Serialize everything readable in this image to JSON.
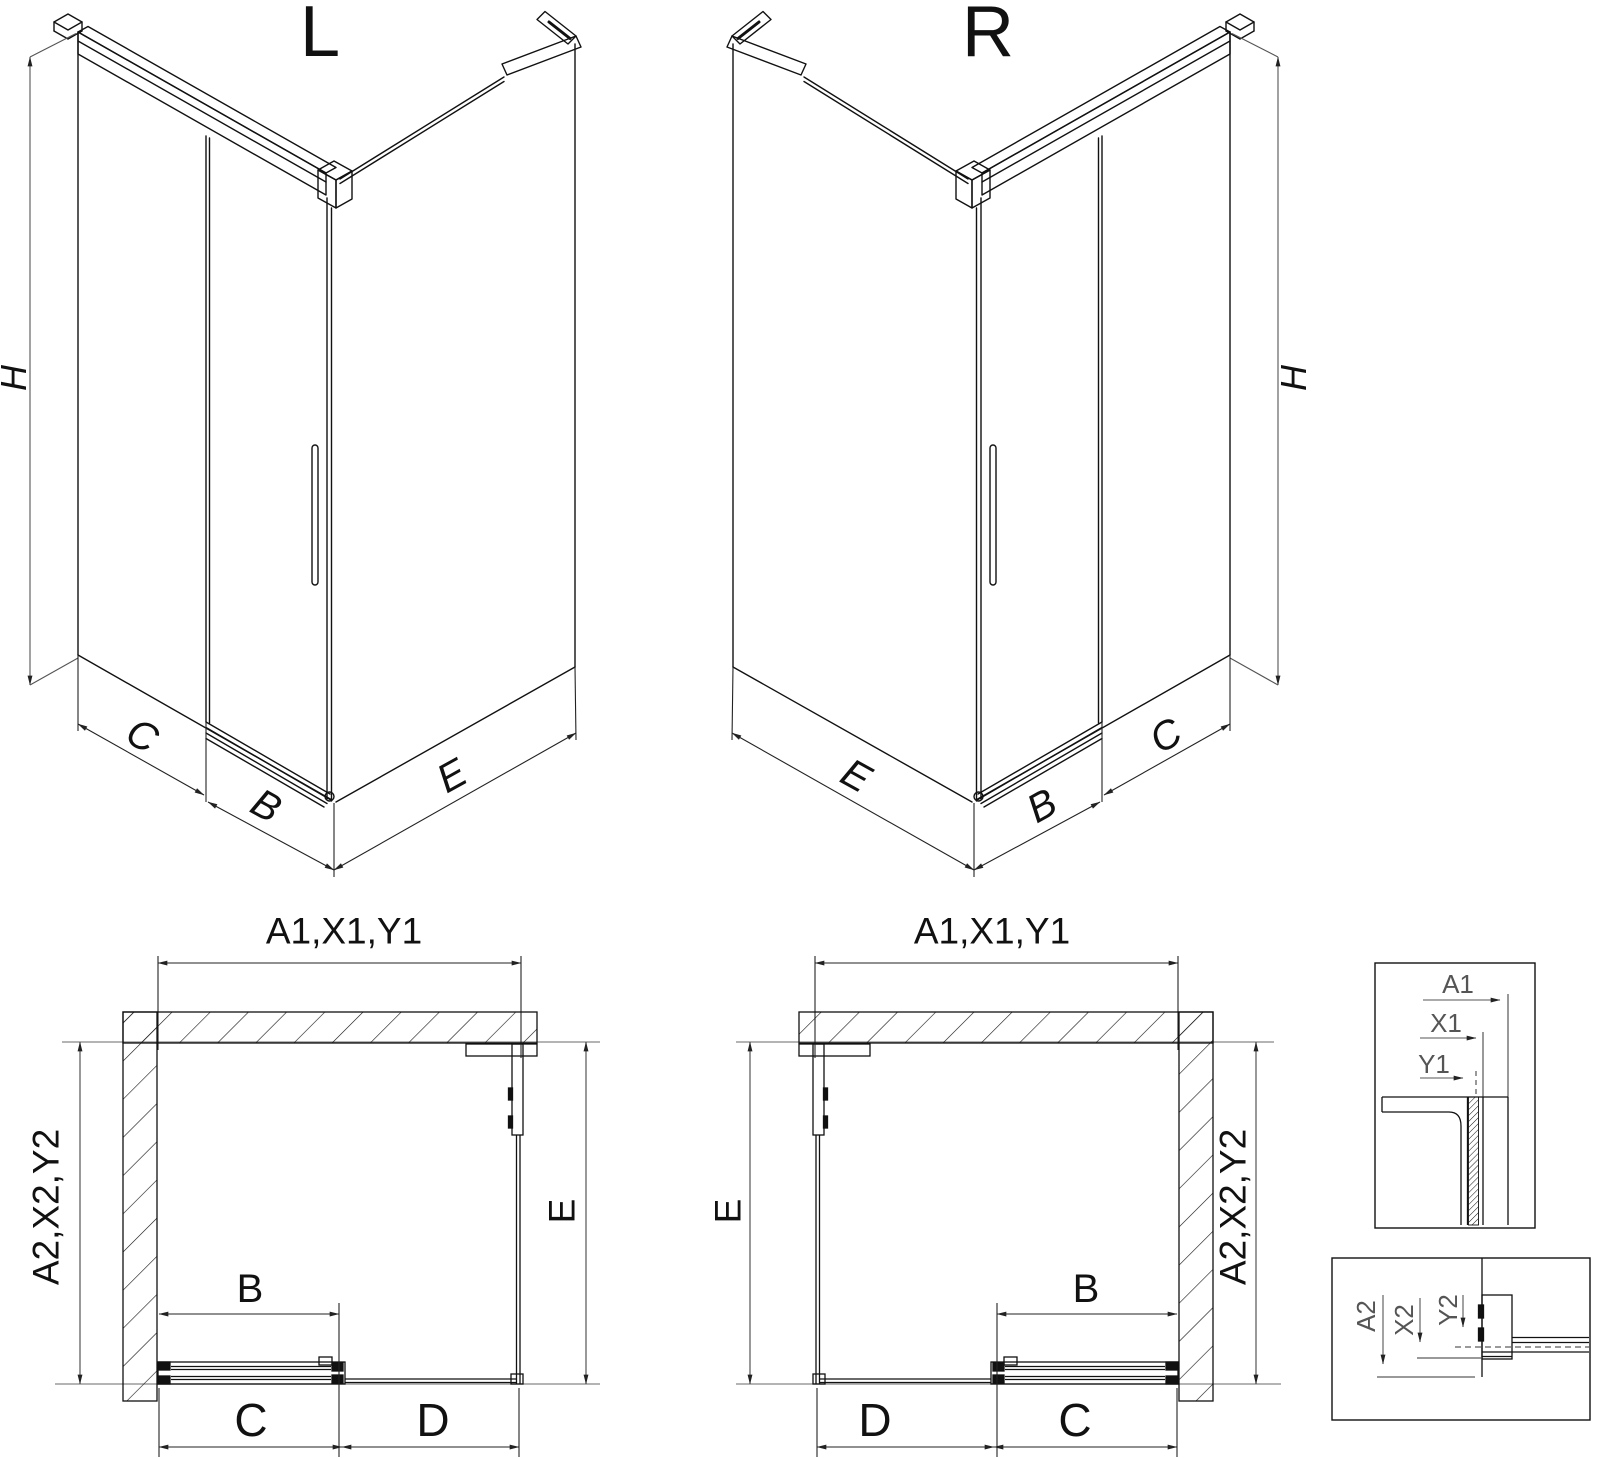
{
  "diagram": {
    "type": "technical-drawing",
    "subject": "Corner shower enclosure with sliding door - left (L) and right (R) hand versions, isometric views, plan views and corner profile detail views",
    "background": "#ffffff",
    "line_color": "#111111",
    "views": {
      "iso_left": {
        "title": "L",
        "height_label": "H",
        "fixed_segment_label": "C",
        "door_label": "B",
        "side_panel_label": "E"
      },
      "iso_right": {
        "title": "R",
        "height_label": "H",
        "fixed_segment_label": "C",
        "door_label": "B",
        "side_panel_label": "E"
      },
      "plan_left": {
        "overall_width_label": "A1,X1,Y1",
        "overall_depth_label": "A2,X2,Y2",
        "door_label": "B",
        "fixed_segment_label": "C",
        "opening_label": "D",
        "side_panel_label": "E"
      },
      "plan_right": {
        "overall_width_label": "A1,X1,Y1",
        "overall_depth_label": "A2,X2,Y2",
        "door_label": "B",
        "fixed_segment_label": "C",
        "opening_label": "D",
        "side_panel_label": "E"
      },
      "detail_width": {
        "overall_label": "A1",
        "inner_label": "X1",
        "glass_label": "Y1"
      },
      "detail_depth": {
        "overall_label": "A2",
        "inner_label": "X2",
        "glass_label": "Y2"
      }
    }
  }
}
